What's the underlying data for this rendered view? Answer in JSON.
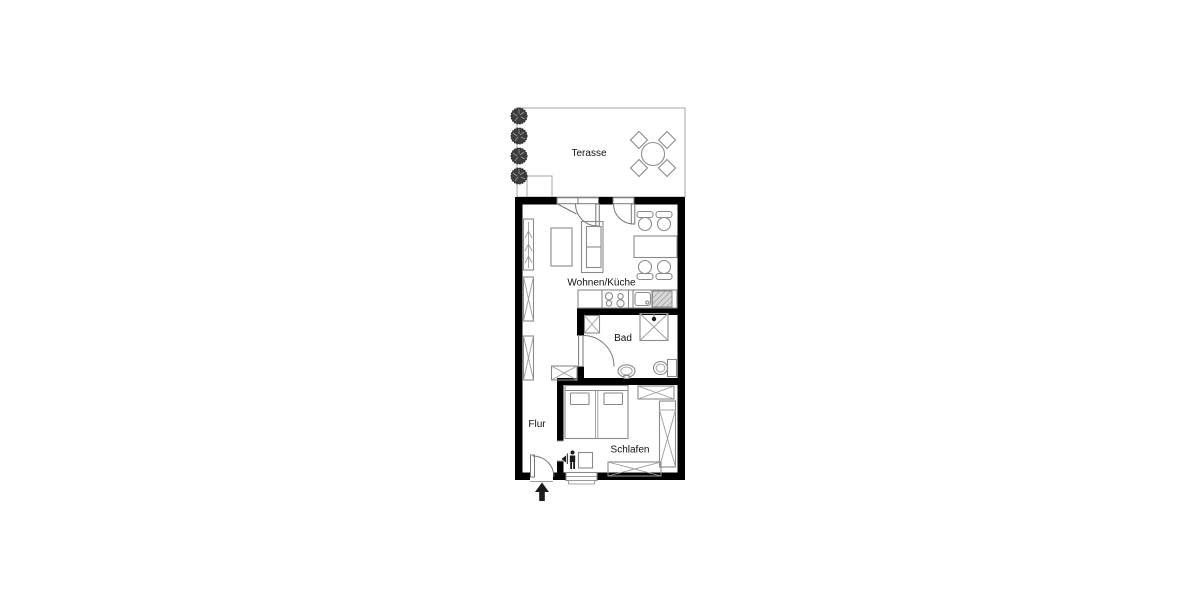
{
  "page": {
    "title": "Apartment floor plan",
    "background": "#ffffff"
  },
  "rooms": {
    "terrace": "Terasse",
    "living_kitchen": "Wohnen/Küche",
    "bath": "Bad",
    "hall": "Flur",
    "bedroom": "Schlafen"
  },
  "colors": {
    "wall": "#000000",
    "furniture_outline": "#8a8a8a",
    "appliance_fill": "#d8d8d8",
    "tree_fill": "#3d3d3d",
    "entrance_arrow": "#111111",
    "background": "#ffffff"
  },
  "symbols": {
    "entrance_marker": "arrow-up",
    "terrace_planting": "4 bushes",
    "terrace_set": "round table with 4 chairs",
    "beds": "double bed with 2 pillows",
    "kitchen_line": "counter, cooktop, sink, appliance",
    "bath_fixtures": "shower, washbasin, wc, shaft"
  }
}
